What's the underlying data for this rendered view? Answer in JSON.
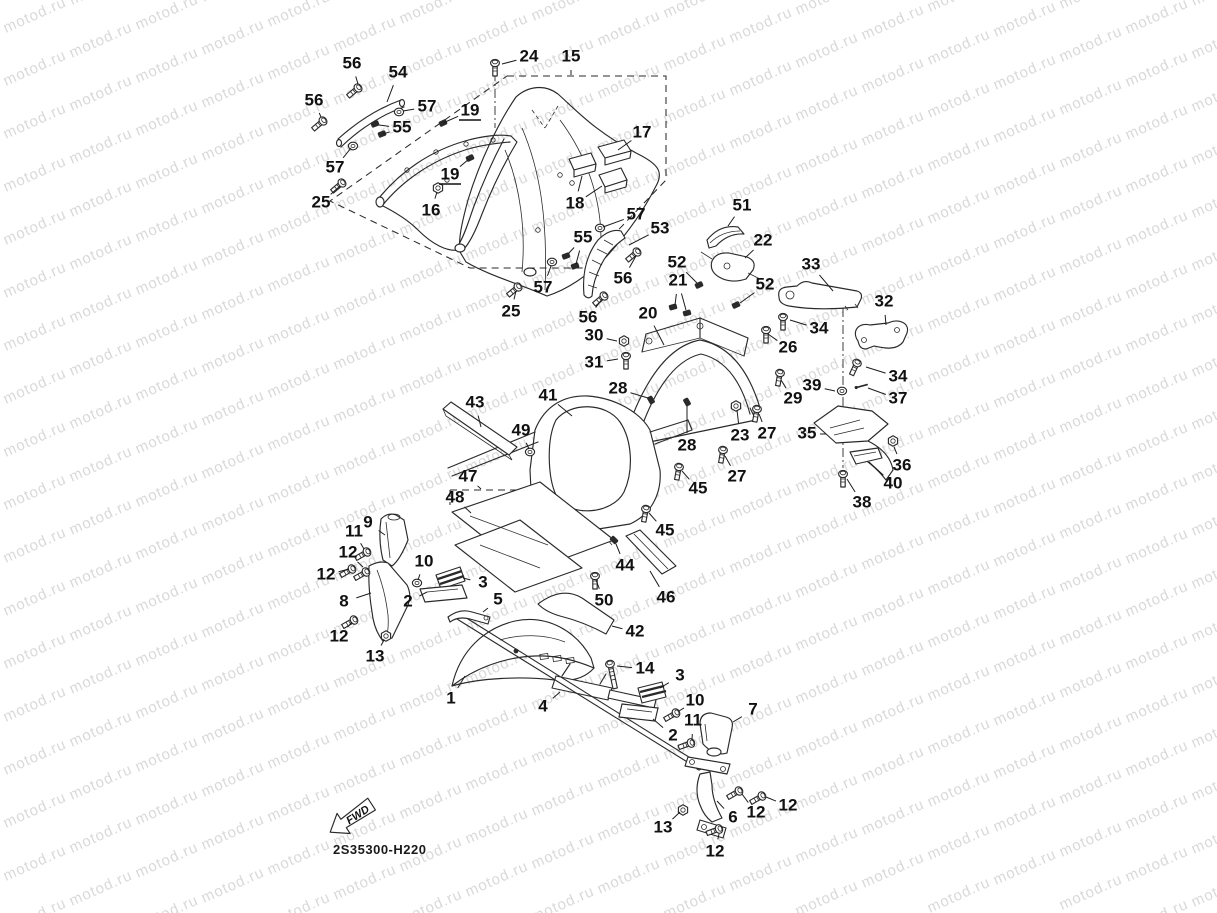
{
  "watermark": {
    "text": "motod.ru",
    "color": "#d9d9d9"
  },
  "drawing_code": {
    "text": "2S35300-H220"
  },
  "fwd_arrow": {
    "label": "FWD"
  },
  "callouts": [
    {
      "n": "56",
      "x": 352,
      "y": 64,
      "tx": 358,
      "ty": 84
    },
    {
      "n": "54",
      "x": 398,
      "y": 73,
      "tx": 387,
      "ty": 102
    },
    {
      "n": "24",
      "x": 529,
      "y": 57,
      "tx": 502,
      "ty": 64
    },
    {
      "n": "15",
      "x": 571,
      "y": 57,
      "tx": 571,
      "ty": 75
    },
    {
      "n": "56",
      "x": 314,
      "y": 101,
      "tx": 321,
      "ty": 117
    },
    {
      "n": "57",
      "x": 427,
      "y": 107,
      "tx": 403,
      "ty": 111
    },
    {
      "n": "19",
      "x": 470,
      "y": 111,
      "tx": 443,
      "ty": 123,
      "u": true
    },
    {
      "n": "55",
      "x": 402,
      "y": 128,
      "tx": 379,
      "ty": 125,
      "tx2": 383,
      "ty2": 134
    },
    {
      "n": "17",
      "x": 642,
      "y": 133,
      "tx": 618,
      "ty": 150
    },
    {
      "n": "57",
      "x": 335,
      "y": 168,
      "tx": 351,
      "ty": 148
    },
    {
      "n": "19",
      "x": 450,
      "y": 175,
      "tx": 469,
      "ty": 159,
      "u": true
    },
    {
      "n": "25",
      "x": 321,
      "y": 203,
      "tx": 340,
      "ty": 186
    },
    {
      "n": "16",
      "x": 431,
      "y": 211,
      "tx": 437,
      "ty": 192
    },
    {
      "n": "18",
      "x": 575,
      "y": 204,
      "tx": 582,
      "ty": 176,
      "tx2": 602,
      "ty2": 186
    },
    {
      "n": "57",
      "x": 636,
      "y": 215,
      "tx": 603,
      "ty": 227
    },
    {
      "n": "53",
      "x": 660,
      "y": 229,
      "tx": 629,
      "ty": 245
    },
    {
      "n": "55",
      "x": 583,
      "y": 238,
      "tx": 568,
      "ty": 254,
      "tx2": 576,
      "ty2": 264
    },
    {
      "n": "52",
      "x": 677,
      "y": 263,
      "tx": 697,
      "ty": 283
    },
    {
      "n": "56",
      "x": 623,
      "y": 279,
      "tx": 636,
      "ty": 256
    },
    {
      "n": "21",
      "x": 678,
      "y": 281,
      "tx": 675,
      "ty": 305,
      "tx2": 686,
      "ty2": 310
    },
    {
      "n": "57",
      "x": 543,
      "y": 288,
      "tx": 551,
      "ty": 266
    },
    {
      "n": "51",
      "x": 742,
      "y": 206,
      "tx": 728,
      "ty": 226
    },
    {
      "n": "22",
      "x": 763,
      "y": 241,
      "tx": 745,
      "ty": 258
    },
    {
      "n": "25",
      "x": 511,
      "y": 312,
      "tx": 516,
      "ty": 291
    },
    {
      "n": "56",
      "x": 588,
      "y": 318,
      "tx": 602,
      "ty": 299
    },
    {
      "n": "20",
      "x": 648,
      "y": 314,
      "tx": 664,
      "ty": 345
    },
    {
      "n": "52",
      "x": 765,
      "y": 285,
      "tx": 740,
      "ty": 303
    },
    {
      "n": "33",
      "x": 811,
      "y": 265,
      "tx": 833,
      "ty": 291
    },
    {
      "n": "32",
      "x": 884,
      "y": 302,
      "tx": 886,
      "ty": 325
    },
    {
      "n": "30",
      "x": 594,
      "y": 336,
      "tx": 617,
      "ty": 341
    },
    {
      "n": "31",
      "x": 594,
      "y": 363,
      "tx": 618,
      "ty": 359
    },
    {
      "n": "26",
      "x": 788,
      "y": 348,
      "tx": 768,
      "ty": 334
    },
    {
      "n": "34",
      "x": 819,
      "y": 329,
      "tx": 790,
      "ty": 320
    },
    {
      "n": "34",
      "x": 898,
      "y": 377,
      "tx": 866,
      "ty": 367
    },
    {
      "n": "39",
      "x": 812,
      "y": 386,
      "tx": 835,
      "ty": 391
    },
    {
      "n": "37",
      "x": 898,
      "y": 399,
      "tx": 868,
      "ty": 388
    },
    {
      "n": "29",
      "x": 793,
      "y": 399,
      "tx": 781,
      "ty": 380
    },
    {
      "n": "28",
      "x": 618,
      "y": 389,
      "tx": 648,
      "ty": 398
    },
    {
      "n": "27",
      "x": 767,
      "y": 434,
      "tx": 759,
      "ty": 414
    },
    {
      "n": "23",
      "x": 740,
      "y": 436,
      "tx": 737,
      "ty": 410
    },
    {
      "n": "35",
      "x": 807,
      "y": 434,
      "tx": 826,
      "ty": 434
    },
    {
      "n": "36",
      "x": 902,
      "y": 466,
      "tx": 894,
      "ty": 447
    },
    {
      "n": "40",
      "x": 893,
      "y": 484,
      "tx": 869,
      "ty": 462
    },
    {
      "n": "38",
      "x": 862,
      "y": 503,
      "tx": 847,
      "ty": 479
    },
    {
      "n": "28",
      "x": 687,
      "y": 446,
      "tx": 687,
      "ty": 406
    },
    {
      "n": "27",
      "x": 737,
      "y": 477,
      "tx": 725,
      "ty": 456
    },
    {
      "n": "45",
      "x": 698,
      "y": 489,
      "tx": 682,
      "ty": 471
    },
    {
      "n": "41",
      "x": 548,
      "y": 396,
      "tx": 572,
      "ty": 416
    },
    {
      "n": "43",
      "x": 475,
      "y": 403,
      "tx": 481,
      "ty": 427
    },
    {
      "n": "49",
      "x": 521,
      "y": 431,
      "tx": 529,
      "ty": 449
    },
    {
      "n": "45",
      "x": 665,
      "y": 531,
      "tx": 649,
      "ty": 513
    },
    {
      "n": "47",
      "x": 468,
      "y": 477,
      "tx": 481,
      "ty": 489
    },
    {
      "n": "48",
      "x": 455,
      "y": 498,
      "tx": 471,
      "ty": 513
    },
    {
      "n": "44",
      "x": 625,
      "y": 566,
      "tx": 616,
      "ty": 544
    },
    {
      "n": "50",
      "x": 604,
      "y": 601,
      "tx": 596,
      "ty": 580
    },
    {
      "n": "46",
      "x": 666,
      "y": 598,
      "tx": 650,
      "ty": 571
    },
    {
      "n": "42",
      "x": 635,
      "y": 632,
      "tx": 612,
      "ty": 626
    },
    {
      "n": "9",
      "x": 368,
      "y": 523,
      "tx": 385,
      "ty": 535
    },
    {
      "n": "11",
      "x": 354,
      "y": 532,
      "tx": 364,
      "ty": 549
    },
    {
      "n": "12",
      "x": 348,
      "y": 553,
      "tx": 363,
      "ty": 567
    },
    {
      "n": "12",
      "x": 326,
      "y": 575,
      "tx": 349,
      "ty": 569
    },
    {
      "n": "10",
      "x": 424,
      "y": 562,
      "tx": 418,
      "ty": 580
    },
    {
      "n": "8",
      "x": 344,
      "y": 602,
      "tx": 371,
      "ty": 593
    },
    {
      "n": "2",
      "x": 408,
      "y": 602,
      "tx": 427,
      "ty": 592
    },
    {
      "n": "3",
      "x": 483,
      "y": 583,
      "tx": 463,
      "ty": 578
    },
    {
      "n": "5",
      "x": 498,
      "y": 600,
      "tx": 483,
      "ty": 612
    },
    {
      "n": "12",
      "x": 339,
      "y": 637,
      "tx": 352,
      "ty": 622
    },
    {
      "n": "13",
      "x": 375,
      "y": 657,
      "tx": 384,
      "ty": 640
    },
    {
      "n": "1",
      "x": 451,
      "y": 699,
      "tx": 465,
      "ty": 676
    },
    {
      "n": "4",
      "x": 543,
      "y": 707,
      "tx": 560,
      "ty": 692
    },
    {
      "n": "14",
      "x": 645,
      "y": 669,
      "tx": 617,
      "ty": 666
    },
    {
      "n": "3",
      "x": 680,
      "y": 676,
      "tx": 660,
      "ty": 688
    },
    {
      "n": "10",
      "x": 695,
      "y": 701,
      "tx": 679,
      "ty": 711
    },
    {
      "n": "11",
      "x": 693,
      "y": 721,
      "tx": 692,
      "ty": 740
    },
    {
      "n": "2",
      "x": 673,
      "y": 736,
      "tx": 653,
      "ty": 719
    },
    {
      "n": "7",
      "x": 753,
      "y": 710,
      "tx": 733,
      "ty": 722
    },
    {
      "n": "12",
      "x": 788,
      "y": 806,
      "tx": 766,
      "ty": 797
    },
    {
      "n": "12",
      "x": 756,
      "y": 813,
      "tx": 742,
      "ty": 794
    },
    {
      "n": "6",
      "x": 733,
      "y": 818,
      "tx": 717,
      "ty": 801
    },
    {
      "n": "13",
      "x": 663,
      "y": 828,
      "tx": 680,
      "ty": 812
    },
    {
      "n": "12",
      "x": 715,
      "y": 852,
      "tx": 719,
      "ty": 834
    }
  ],
  "fasteners": [
    {
      "t": "bolt",
      "x": 358,
      "y": 88,
      "a": 140
    },
    {
      "t": "bolt",
      "x": 323,
      "y": 121,
      "a": 140
    },
    {
      "t": "bolt",
      "x": 342,
      "y": 183,
      "a": 140
    },
    {
      "t": "bolt",
      "x": 495,
      "y": 63,
      "a": 90
    },
    {
      "t": "bolt",
      "x": 637,
      "y": 252,
      "a": 140
    },
    {
      "t": "bolt",
      "x": 604,
      "y": 296,
      "a": 140
    },
    {
      "t": "bolt",
      "x": 518,
      "y": 287,
      "a": 140
    },
    {
      "t": "bolt",
      "x": 783,
      "y": 317,
      "a": 90
    },
    {
      "t": "bolt",
      "x": 766,
      "y": 330,
      "a": 90
    },
    {
      "t": "bolt",
      "x": 780,
      "y": 373,
      "a": 100
    },
    {
      "t": "bolt",
      "x": 757,
      "y": 409,
      "a": 100
    },
    {
      "t": "bolt",
      "x": 723,
      "y": 450,
      "a": 100
    },
    {
      "t": "bolt",
      "x": 679,
      "y": 467,
      "a": 100
    },
    {
      "t": "bolt",
      "x": 646,
      "y": 509,
      "a": 100
    },
    {
      "t": "bolt",
      "x": 857,
      "y": 363,
      "a": 115
    },
    {
      "t": "bolt",
      "x": 843,
      "y": 474,
      "a": 90
    },
    {
      "t": "bolt",
      "x": 595,
      "y": 576,
      "a": 90
    },
    {
      "t": "bolt",
      "x": 626,
      "y": 356,
      "a": 90
    },
    {
      "t": "bolt",
      "x": 367,
      "y": 552,
      "a": 150
    },
    {
      "t": "bolt",
      "x": 352,
      "y": 569,
      "a": 150
    },
    {
      "t": "bolt",
      "x": 366,
      "y": 572,
      "a": 150
    },
    {
      "t": "bolt",
      "x": 354,
      "y": 620,
      "a": 150
    },
    {
      "t": "bolt",
      "x": 676,
      "y": 713,
      "a": 150
    },
    {
      "t": "bolt",
      "x": 691,
      "y": 743,
      "a": 160
    },
    {
      "t": "bolt",
      "x": 739,
      "y": 791,
      "a": 150
    },
    {
      "t": "bolt",
      "x": 762,
      "y": 796,
      "a": 150
    },
    {
      "t": "bolt",
      "x": 719,
      "y": 829,
      "a": 160
    },
    {
      "t": "longbolt",
      "x": 610,
      "y": 664,
      "a": 78
    },
    {
      "t": "nut",
      "x": 438,
      "y": 188,
      "a": 0
    },
    {
      "t": "nut",
      "x": 624,
      "y": 341,
      "a": 0
    },
    {
      "t": "nut",
      "x": 736,
      "y": 406,
      "a": 0
    },
    {
      "t": "nut",
      "x": 893,
      "y": 441,
      "a": 0
    },
    {
      "t": "nut",
      "x": 386,
      "y": 636,
      "a": 0
    },
    {
      "t": "nut",
      "x": 683,
      "y": 810,
      "a": 0
    },
    {
      "t": "washer",
      "x": 399,
      "y": 112,
      "a": 0
    },
    {
      "t": "washer",
      "x": 353,
      "y": 146,
      "a": 0
    },
    {
      "t": "washer",
      "x": 600,
      "y": 228,
      "a": 0
    },
    {
      "t": "washer",
      "x": 552,
      "y": 262,
      "a": 0
    },
    {
      "t": "washer",
      "x": 842,
      "y": 391,
      "a": 0
    },
    {
      "t": "washer",
      "x": 530,
      "y": 452,
      "a": 0
    },
    {
      "t": "washer",
      "x": 417,
      "y": 583,
      "a": 0
    },
    {
      "t": "clip",
      "x": 375,
      "y": 124,
      "a": -20
    },
    {
      "t": "clip",
      "x": 382,
      "y": 134,
      "a": -20
    },
    {
      "t": "clip",
      "x": 566,
      "y": 256,
      "a": -20
    },
    {
      "t": "clip",
      "x": 575,
      "y": 266,
      "a": -20
    },
    {
      "t": "clip",
      "x": 699,
      "y": 285,
      "a": -25
    },
    {
      "t": "clip",
      "x": 736,
      "y": 305,
      "a": -25
    },
    {
      "t": "clip",
      "x": 673,
      "y": 307,
      "a": -15
    },
    {
      "t": "clip",
      "x": 687,
      "y": 313,
      "a": -15
    },
    {
      "t": "clip",
      "x": 651,
      "y": 400,
      "a": 60
    },
    {
      "t": "clip",
      "x": 687,
      "y": 402,
      "a": 60
    },
    {
      "t": "clip",
      "x": 614,
      "y": 540,
      "a": 45
    },
    {
      "t": "clip",
      "x": 443,
      "y": 123,
      "a": -25
    },
    {
      "t": "clip",
      "x": 470,
      "y": 158,
      "a": -25
    },
    {
      "t": "pin",
      "x": 862,
      "y": 386,
      "a": -15
    }
  ]
}
